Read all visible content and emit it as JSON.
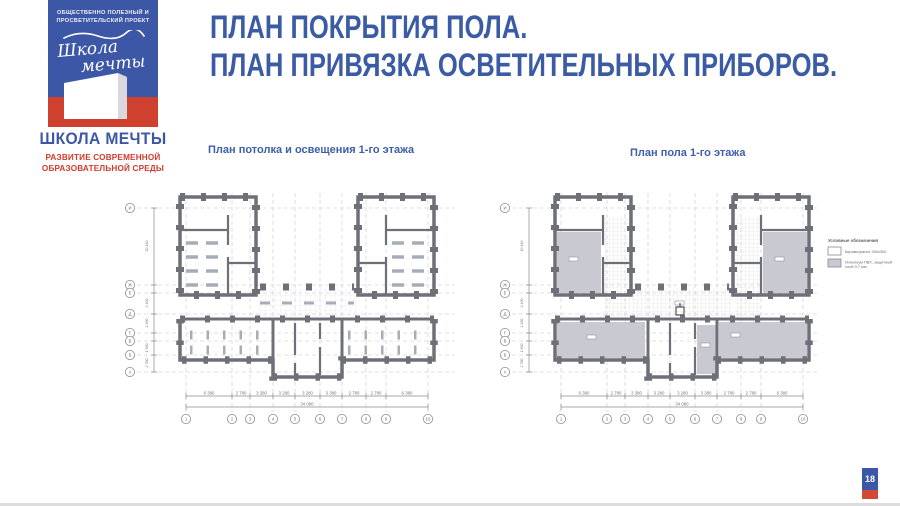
{
  "branding": {
    "logo_caption_line1": "ОБЩЕСТВЕННО ПОЛЕЗНЫЙ И",
    "logo_caption_line2": "ПРОСВЕТИТЕЛЬСКИЙ ПРОЕКТ",
    "logo_script_line1": "Школа",
    "logo_script_line2": "мечты",
    "org_name": "ШКОЛА МЕЧТЫ",
    "tagline_line1": "РАЗВИТИЕ СОВРЕМЕННОЙ",
    "tagline_line2": "ОБРАЗОВАТЕЛЬНОЙ СРЕДЫ"
  },
  "header": {
    "title_line1": "ПЛАН ПОКРЫТИЯ ПОЛА.",
    "title_line2": "ПЛАН ПРИВЯЗКА ОСВЕТИТЕЛЬНЫХ ПРИБОРОВ."
  },
  "plans": {
    "left": {
      "caption": "План потолка и освещения 1-го этажа"
    },
    "right": {
      "caption": "План пола 1-го этажа",
      "legend": {
        "title": "Условные обозначения",
        "item1_label": "Керамогранит 300х300",
        "item2_label_line1": "Линолеум ПВХ, защитный",
        "item2_label_line2": "слой 0,7 мм"
      }
    }
  },
  "axes": {
    "bottom_numbers": [
      "1",
      "2",
      "3",
      "4",
      "5",
      "6",
      "7",
      "8",
      "9",
      "10"
    ],
    "left_letters": [
      "И",
      "Ж",
      "Е",
      "Д",
      "Г",
      "В",
      "Б",
      "А"
    ],
    "dims": [
      "6 380",
      "2 780",
      "3 380",
      "3 280",
      "3 280",
      "3 380",
      "2 780",
      "2 780",
      "6 380"
    ],
    "total": "34 080",
    "side_dims": [
      "10 140",
      "2 400",
      "2 450",
      "1 930",
      "2 780"
    ]
  },
  "footer": {
    "page_number": "18"
  },
  "colors": {
    "accent_blue": "#3b5ba4",
    "accent_red": "#cf3a2c",
    "wall_gray": "#6f6f78",
    "room_fill": "#c9c9d1"
  }
}
